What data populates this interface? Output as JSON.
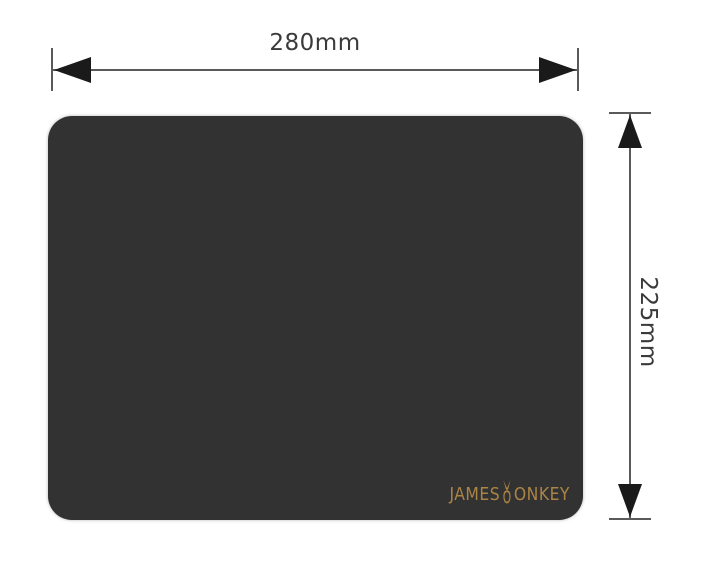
{
  "diagram": {
    "width_dimension": {
      "label": "280mm"
    },
    "height_dimension": {
      "label": "225mm"
    }
  },
  "mousepad": {
    "brand": {
      "prefix": "JAMES",
      "suffix": "ONKEY",
      "icon": "donkey-head-icon"
    },
    "pad_color": "#323232",
    "brand_color": "#ab8446"
  },
  "colors": {
    "background": "#ffffff",
    "dimension_line": "#5a5a5a",
    "arrowhead": "#1a1a1a",
    "label_text": "#3a3a3a"
  }
}
